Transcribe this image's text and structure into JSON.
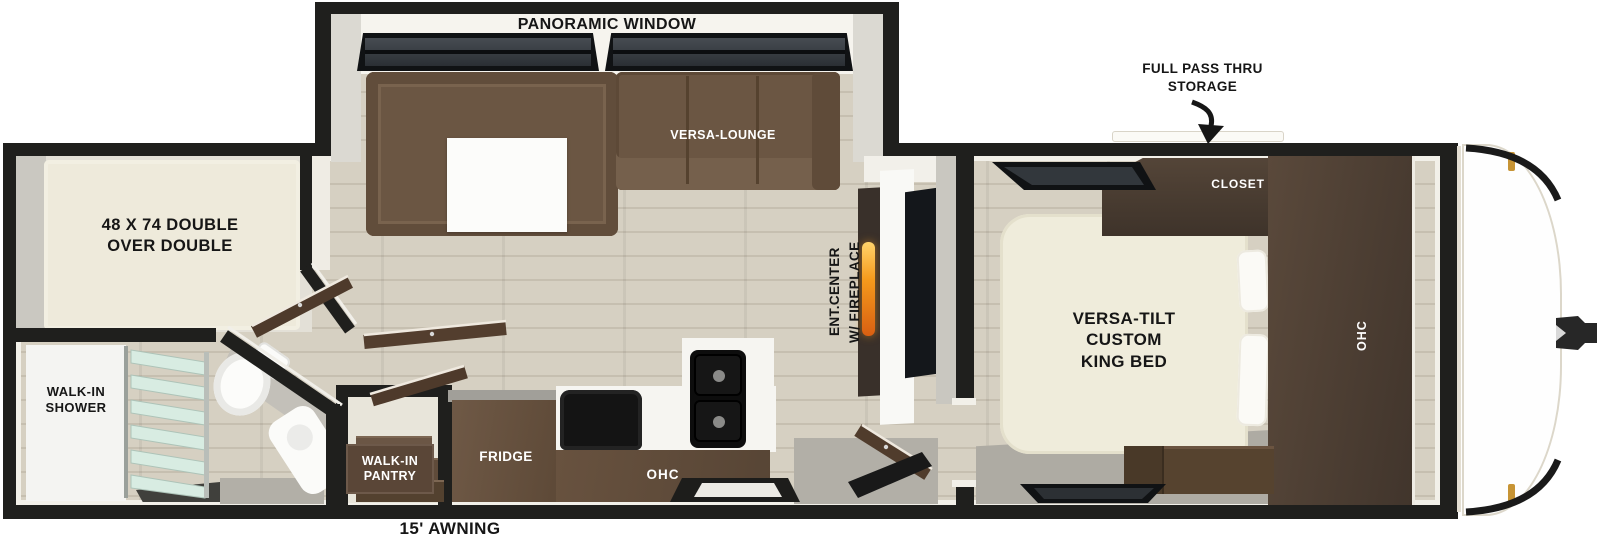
{
  "title": "Travel trailer floor plan",
  "labels": {
    "panoramic_window": "PANORAMIC WINDOW",
    "full_pass_thru_storage": "FULL PASS THRU\nSTORAGE",
    "versa_lounge": "VERSA-LOUNGE",
    "bunk_bed": "48 X 74 DOUBLE\nOVER DOUBLE",
    "closet": "CLOSET",
    "ent_center": "ENT.CENTER\nW/ FIREPLACE",
    "king_bed": "VERSA-TILT\nCUSTOM\nKING BED",
    "bedroom_ohc": "OHC",
    "walk_in_shower": "WALK-IN\nSHOWER",
    "walk_in_pantry": "WALK-IN\nPANTRY",
    "fridge": "FRIDGE",
    "kitchen_ohc": "OHC",
    "awning": "15' AWNING"
  },
  "colors": {
    "wall": "#1f1f1d",
    "floor": "#d6d0c2",
    "sofa_brown": "#6b5643",
    "cabinet_wood": "#63503e",
    "dark_wood": "#46382e",
    "mattress_cream": "#eeeadb",
    "shower_glass": "#d8ece2",
    "fireplace_flame": "#f59a1c",
    "marker_light_amber": "#c79435",
    "gray_floor": "#b2afa7",
    "label_text": "#161616",
    "label_text_light": "#ffffff"
  }
}
